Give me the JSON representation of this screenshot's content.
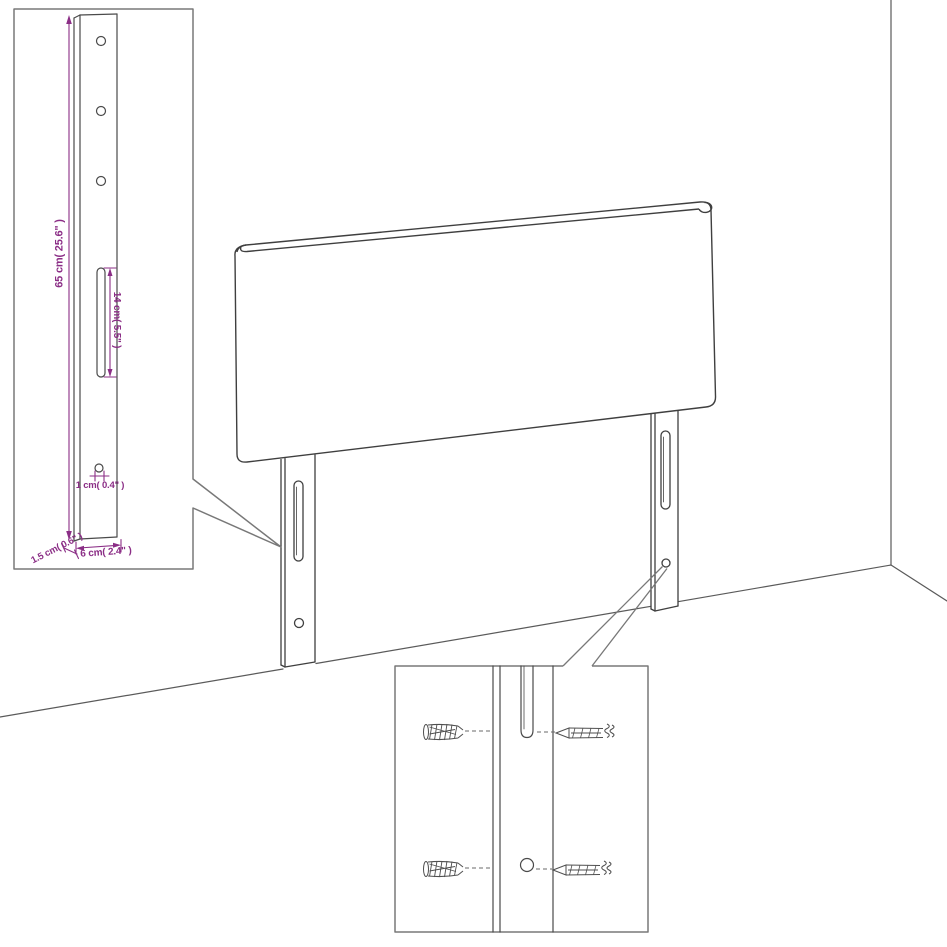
{
  "diagram": {
    "title": "Headboard with mounting legs - dimension diagram",
    "colors": {
      "line": "#3f3f3f",
      "inset_border": "#787878",
      "dimension_accent": "#8b2e86",
      "background": "#ffffff"
    },
    "labels": {
      "leg_height": "65 cm( 25.6\" )",
      "slot_length": "14 cm( 5.5\" )",
      "hole_diameter": "1 cm( 0.4\" )",
      "side_thickness": "1.5 cm( 0.6\" )",
      "leg_width": "6 cm( 2.4\" )"
    },
    "icons": {
      "left_inset": "leg-dimension-detail",
      "bottom_inset": "wall-plug-and-screw-detail",
      "wall_plug": "wall-plug-icon",
      "screw": "screw-icon"
    }
  }
}
